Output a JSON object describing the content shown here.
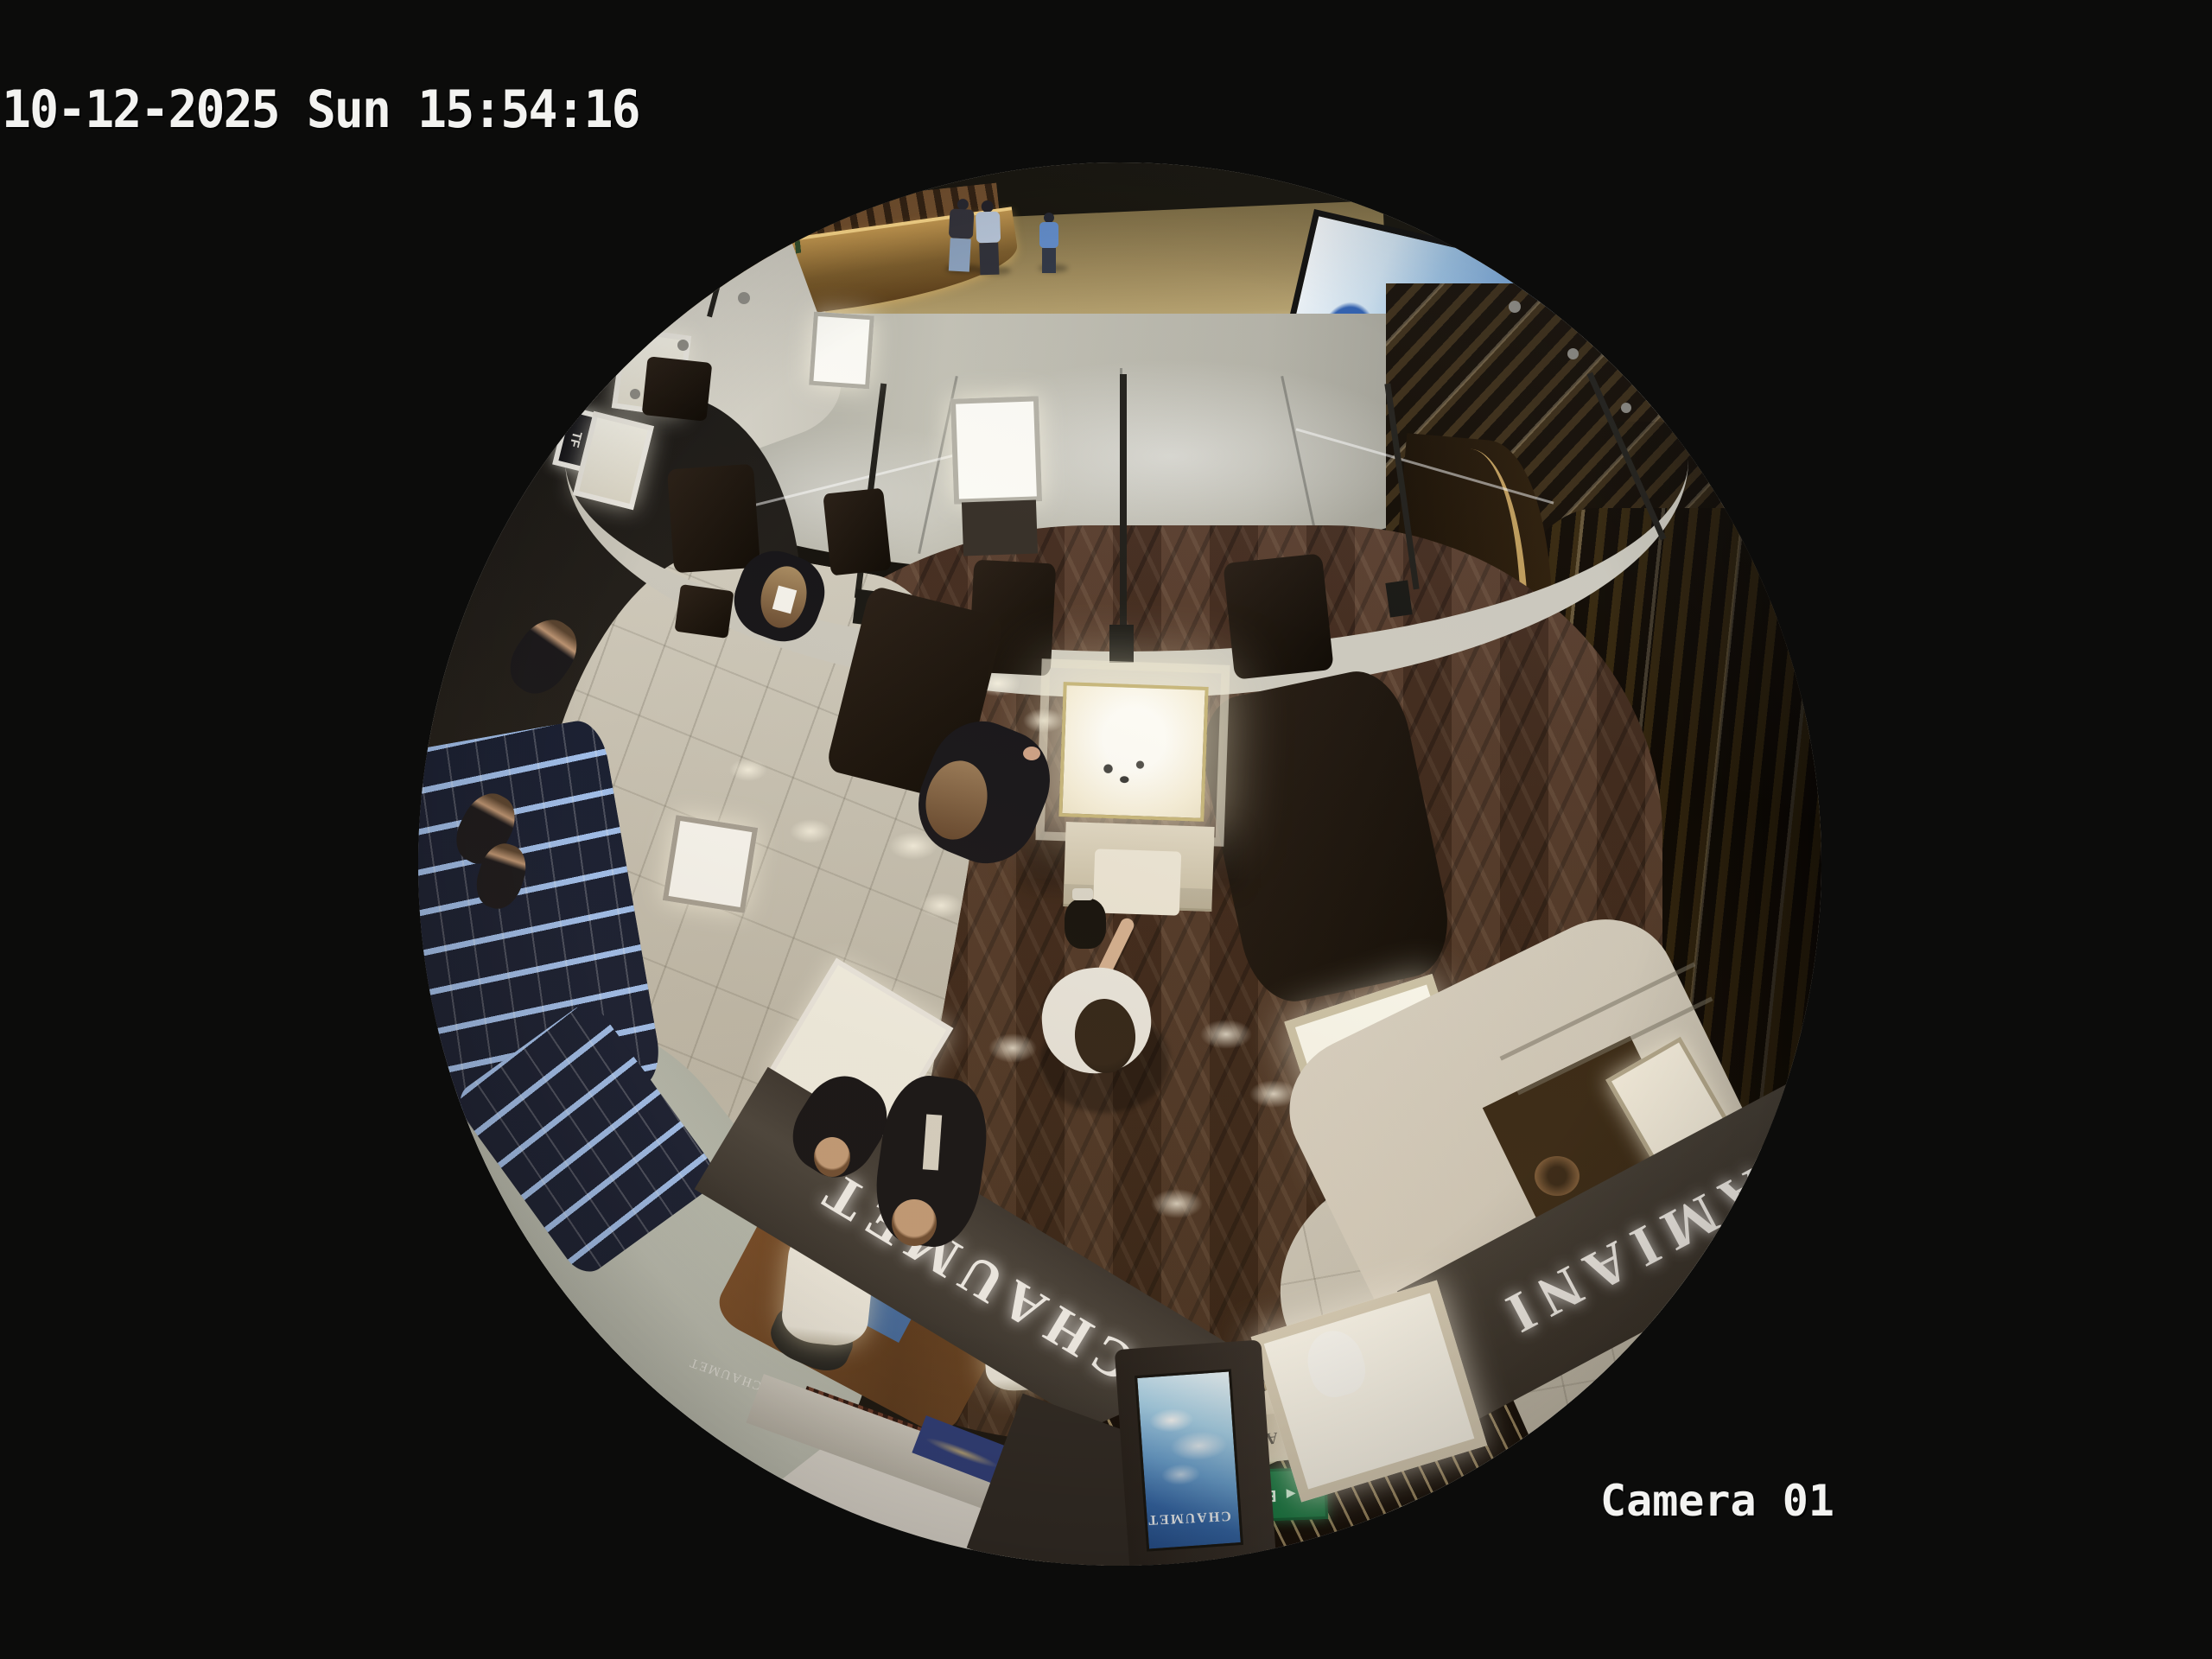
{
  "osd": {
    "timestamp": "10-12-2025 Sun 15:54:16",
    "camera": "Camera 01"
  },
  "signs": {
    "tom_ford": "TOM FORD",
    "tf_monogram": "TF",
    "chaumet_fascia": "CHAUMET",
    "chaumet_fascia_small": "CHAUMET",
    "chaumet_screen": "CHAUMET",
    "damiani_fascia": "DAMIANI",
    "damiani_small": "DAMIANI",
    "exit": "EXIT"
  },
  "icons": {
    "exit_arrow": "◄◄"
  },
  "colors": {
    "background": "#0c0c0b",
    "osd_text": "#f3f3f1",
    "rim_white": "#e4e1da",
    "marble_floor": "#b5b3a7",
    "gold_wall": "#9c8757",
    "screen_blue": "#7aa8da",
    "wood_floor": "#4a3121",
    "tile_floor": "#cac5b6",
    "fascia_dark": "#3b3631",
    "slat_brown": "#34250f",
    "exit_green": "#117a43",
    "kiosk_screen_blue": "#2c64ab",
    "light_wall": "#b3b8ad",
    "counter_glow": "#f2c878"
  }
}
